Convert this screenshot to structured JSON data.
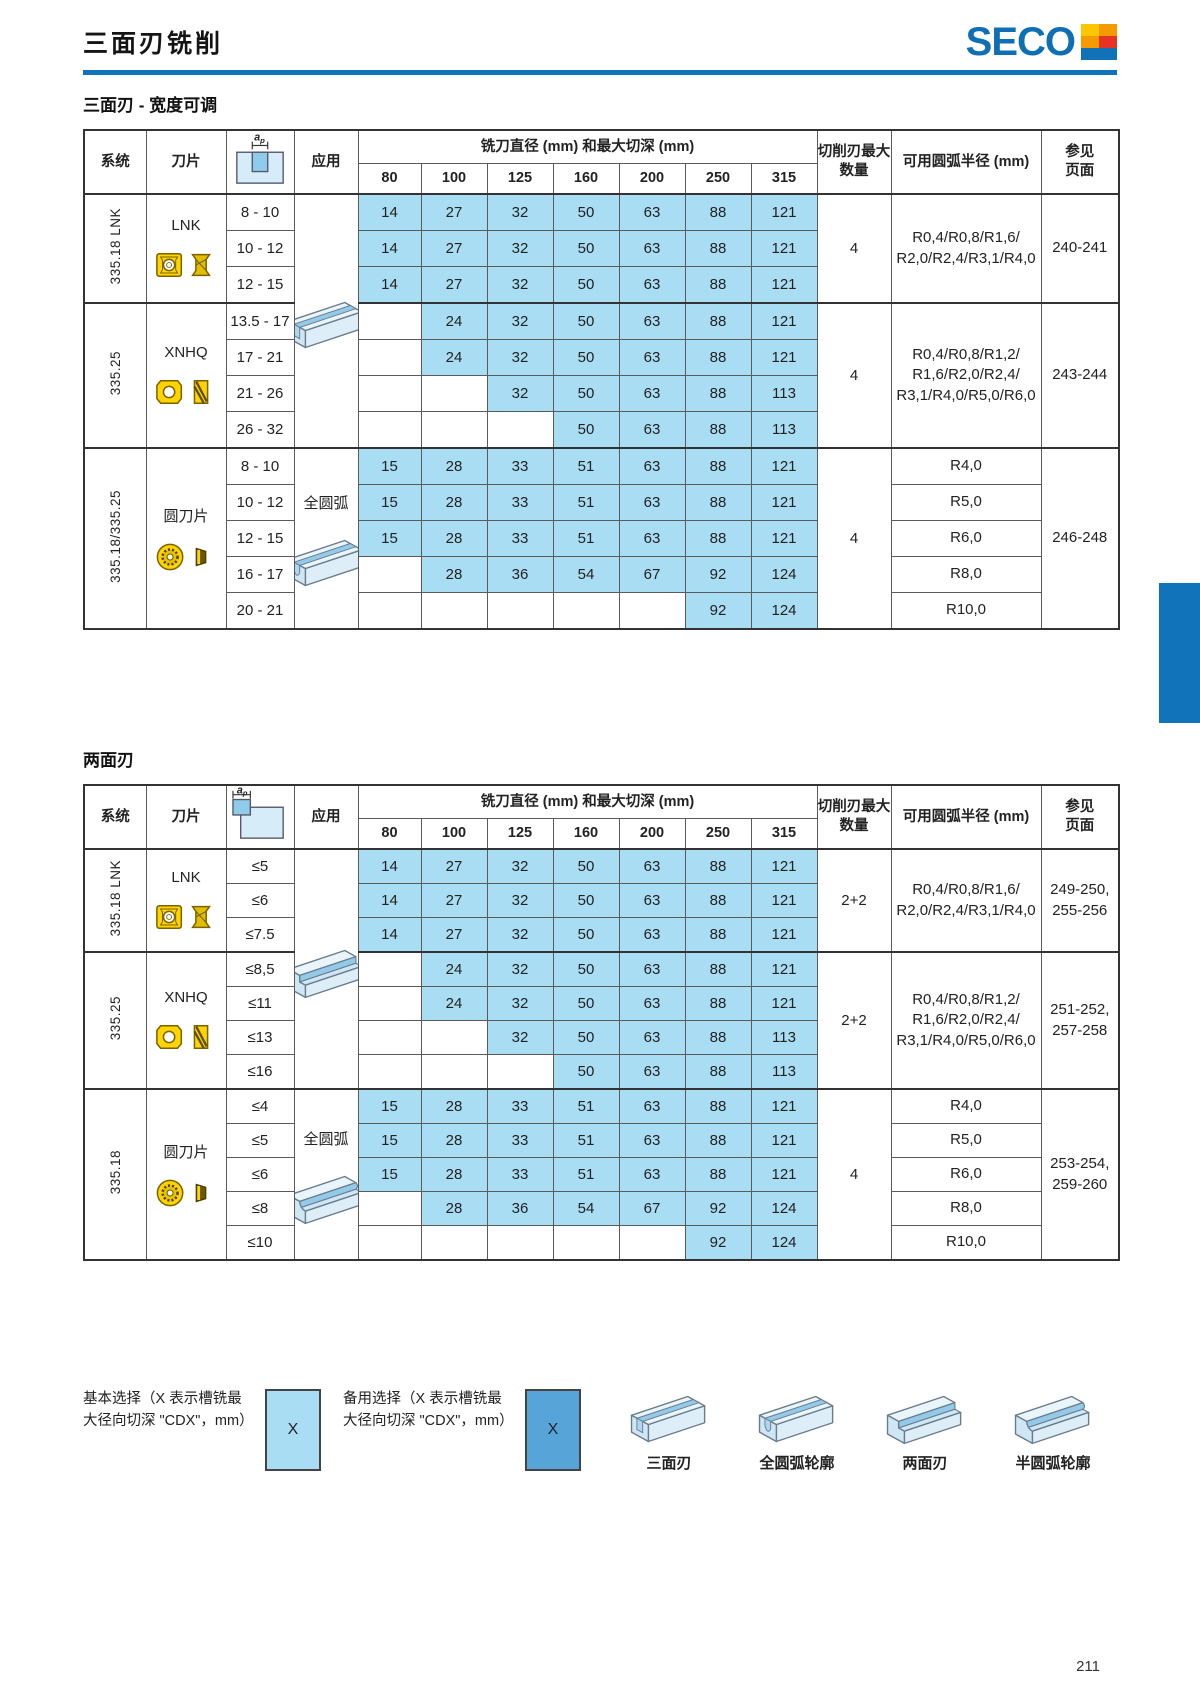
{
  "page": {
    "title": "三面刃铣削",
    "page_number": "211",
    "brand": {
      "name": "SECO",
      "color": "#0e6fb5"
    },
    "colors": {
      "accent_blue": "#1173b9",
      "highlight_cell": "#a9ddf3",
      "legend_alt": "#56a4d8",
      "insert_yellow": "#ffd400"
    }
  },
  "table_header": {
    "system": "系统",
    "insert": "刀片",
    "ap_label": "ap",
    "application": "应用",
    "diameter_header": "铣刀直径 (mm) 和最大切深 (mm)",
    "diameters": [
      "80",
      "100",
      "125",
      "160",
      "200",
      "250",
      "315"
    ],
    "edges": "切削刃最大\n数量",
    "radius": "可用圆弧半径 (mm)",
    "page": "参见\n页面"
  },
  "tables": [
    {
      "section_title": "三面刃 - 宽度可调",
      "table_name": "width-adjustable-table",
      "ap_diagram": "center",
      "app_cells": [
        {
          "group": 0,
          "rowspan": 7,
          "icon": "slot3",
          "text": ""
        },
        {
          "group": 2,
          "rowspan": 5,
          "icon": "slotR",
          "text": "全圆弧"
        }
      ],
      "groups": [
        {
          "system": "335.18 LNK",
          "insert_label": "LNK",
          "insert_icon": "lnk",
          "edges": "4",
          "radius": "R0,4/R0,8/R1,6/\nR2,0/R2,4/R3,1/R4,0",
          "pages": "240-241",
          "rows": [
            {
              "ap": "8 - 10",
              "v": [
                14,
                27,
                32,
                50,
                63,
                88,
                121
              ]
            },
            {
              "ap": "10 - 12",
              "v": [
                14,
                27,
                32,
                50,
                63,
                88,
                121
              ]
            },
            {
              "ap": "12 - 15",
              "v": [
                14,
                27,
                32,
                50,
                63,
                88,
                121
              ]
            }
          ]
        },
        {
          "system": "335.25",
          "insert_label": "XNHQ",
          "insert_icon": "xnhq",
          "edges": "4",
          "radius": "R0,4/R0,8/R1,2/\nR1,6/R2,0/R2,4/\nR3,1/R4,0/R5,0/R6,0",
          "pages": "243-244",
          "rows": [
            {
              "ap": "13.5 - 17",
              "v": [
                null,
                24,
                32,
                50,
                63,
                88,
                121
              ]
            },
            {
              "ap": "17 - 21",
              "v": [
                null,
                24,
                32,
                50,
                63,
                88,
                121
              ]
            },
            {
              "ap": "21 - 26",
              "v": [
                null,
                null,
                32,
                50,
                63,
                88,
                113
              ]
            },
            {
              "ap": "26 - 32",
              "v": [
                null,
                null,
                null,
                50,
                63,
                88,
                113
              ]
            }
          ]
        },
        {
          "system": "335.18/335.25",
          "insert_label": "圆刀片",
          "insert_icon": "round",
          "edges": "4",
          "radius_per_row": true,
          "pages": "246-248",
          "rows": [
            {
              "ap": "8 - 10",
              "v": [
                15,
                28,
                33,
                51,
                63,
                88,
                121
              ],
              "radius": "R4,0"
            },
            {
              "ap": "10 - 12",
              "v": [
                15,
                28,
                33,
                51,
                63,
                88,
                121
              ],
              "radius": "R5,0"
            },
            {
              "ap": "12 - 15",
              "v": [
                15,
                28,
                33,
                51,
                63,
                88,
                121
              ],
              "radius": "R6,0"
            },
            {
              "ap": "16 - 17",
              "v": [
                null,
                28,
                36,
                54,
                67,
                92,
                124
              ],
              "radius": "R8,0"
            },
            {
              "ap": "20 - 21",
              "v": [
                null,
                null,
                null,
                null,
                null,
                92,
                124
              ],
              "radius": "R10,0"
            }
          ]
        }
      ]
    },
    {
      "section_title": "两面刃",
      "table_name": "two-face-table",
      "ap_diagram": "corner",
      "app_cells": [
        {
          "group": 0,
          "rowspan": 7,
          "icon": "step2",
          "text": ""
        },
        {
          "group": 2,
          "rowspan": 5,
          "icon": "stepR",
          "text": "全圆弧"
        }
      ],
      "groups": [
        {
          "system": "335.18 LNK",
          "insert_label": "LNK",
          "insert_icon": "lnk",
          "edges": "2+2",
          "radius": "R0,4/R0,8/R1,6/\nR2,0/R2,4/R3,1/R4,0",
          "pages": "249-250,\n255-256",
          "rows": [
            {
              "ap": "≤5",
              "v": [
                14,
                27,
                32,
                50,
                63,
                88,
                121
              ]
            },
            {
              "ap": "≤6",
              "v": [
                14,
                27,
                32,
                50,
                63,
                88,
                121
              ]
            },
            {
              "ap": "≤7.5",
              "v": [
                14,
                27,
                32,
                50,
                63,
                88,
                121
              ]
            }
          ]
        },
        {
          "system": "335.25",
          "insert_label": "XNHQ",
          "insert_icon": "xnhq",
          "edges": "2+2",
          "radius": "R0,4/R0,8/R1,2/\nR1,6/R2,0/R2,4/\nR3,1/R4,0/R5,0/R6,0",
          "pages": "251-252,\n257-258",
          "rows": [
            {
              "ap": "≤8,5",
              "v": [
                null,
                24,
                32,
                50,
                63,
                88,
                121
              ]
            },
            {
              "ap": "≤11",
              "v": [
                null,
                24,
                32,
                50,
                63,
                88,
                121
              ]
            },
            {
              "ap": "≤13",
              "v": [
                null,
                null,
                32,
                50,
                63,
                88,
                113
              ]
            },
            {
              "ap": "≤16",
              "v": [
                null,
                null,
                null,
                50,
                63,
                88,
                113
              ]
            }
          ]
        },
        {
          "system": "335.18",
          "insert_label": "圆刀片",
          "insert_icon": "round",
          "edges": "4",
          "radius_per_row": true,
          "pages": "253-254,\n259-260",
          "rows": [
            {
              "ap": "≤4",
              "v": [
                15,
                28,
                33,
                51,
                63,
                88,
                121
              ],
              "radius": "R4,0"
            },
            {
              "ap": "≤5",
              "v": [
                15,
                28,
                33,
                51,
                63,
                88,
                121
              ],
              "radius": "R5,0"
            },
            {
              "ap": "≤6",
              "v": [
                15,
                28,
                33,
                51,
                63,
                88,
                121
              ],
              "radius": "R6,0"
            },
            {
              "ap": "≤8",
              "v": [
                null,
                28,
                36,
                54,
                67,
                92,
                124
              ],
              "radius": "R8,0"
            },
            {
              "ap": "≤10",
              "v": [
                null,
                null,
                null,
                null,
                null,
                92,
                124
              ],
              "radius": "R10,0"
            }
          ]
        }
      ]
    }
  ],
  "legend": {
    "primary": {
      "text": "基本选择（X 表示槽铣最大径向切深 \"CDX\"，mm）",
      "box_label": "X"
    },
    "secondary": {
      "text": "备用选择（X 表示槽铣最大径向切深 \"CDX\"，mm）",
      "box_label": "X"
    },
    "profiles": [
      {
        "label": "三面刃",
        "icon": "slot3"
      },
      {
        "label": "全圆弧轮廓",
        "icon": "slotR"
      },
      {
        "label": "两面刃",
        "icon": "step2"
      },
      {
        "label": "半圆弧轮廓",
        "icon": "stepR"
      }
    ]
  }
}
